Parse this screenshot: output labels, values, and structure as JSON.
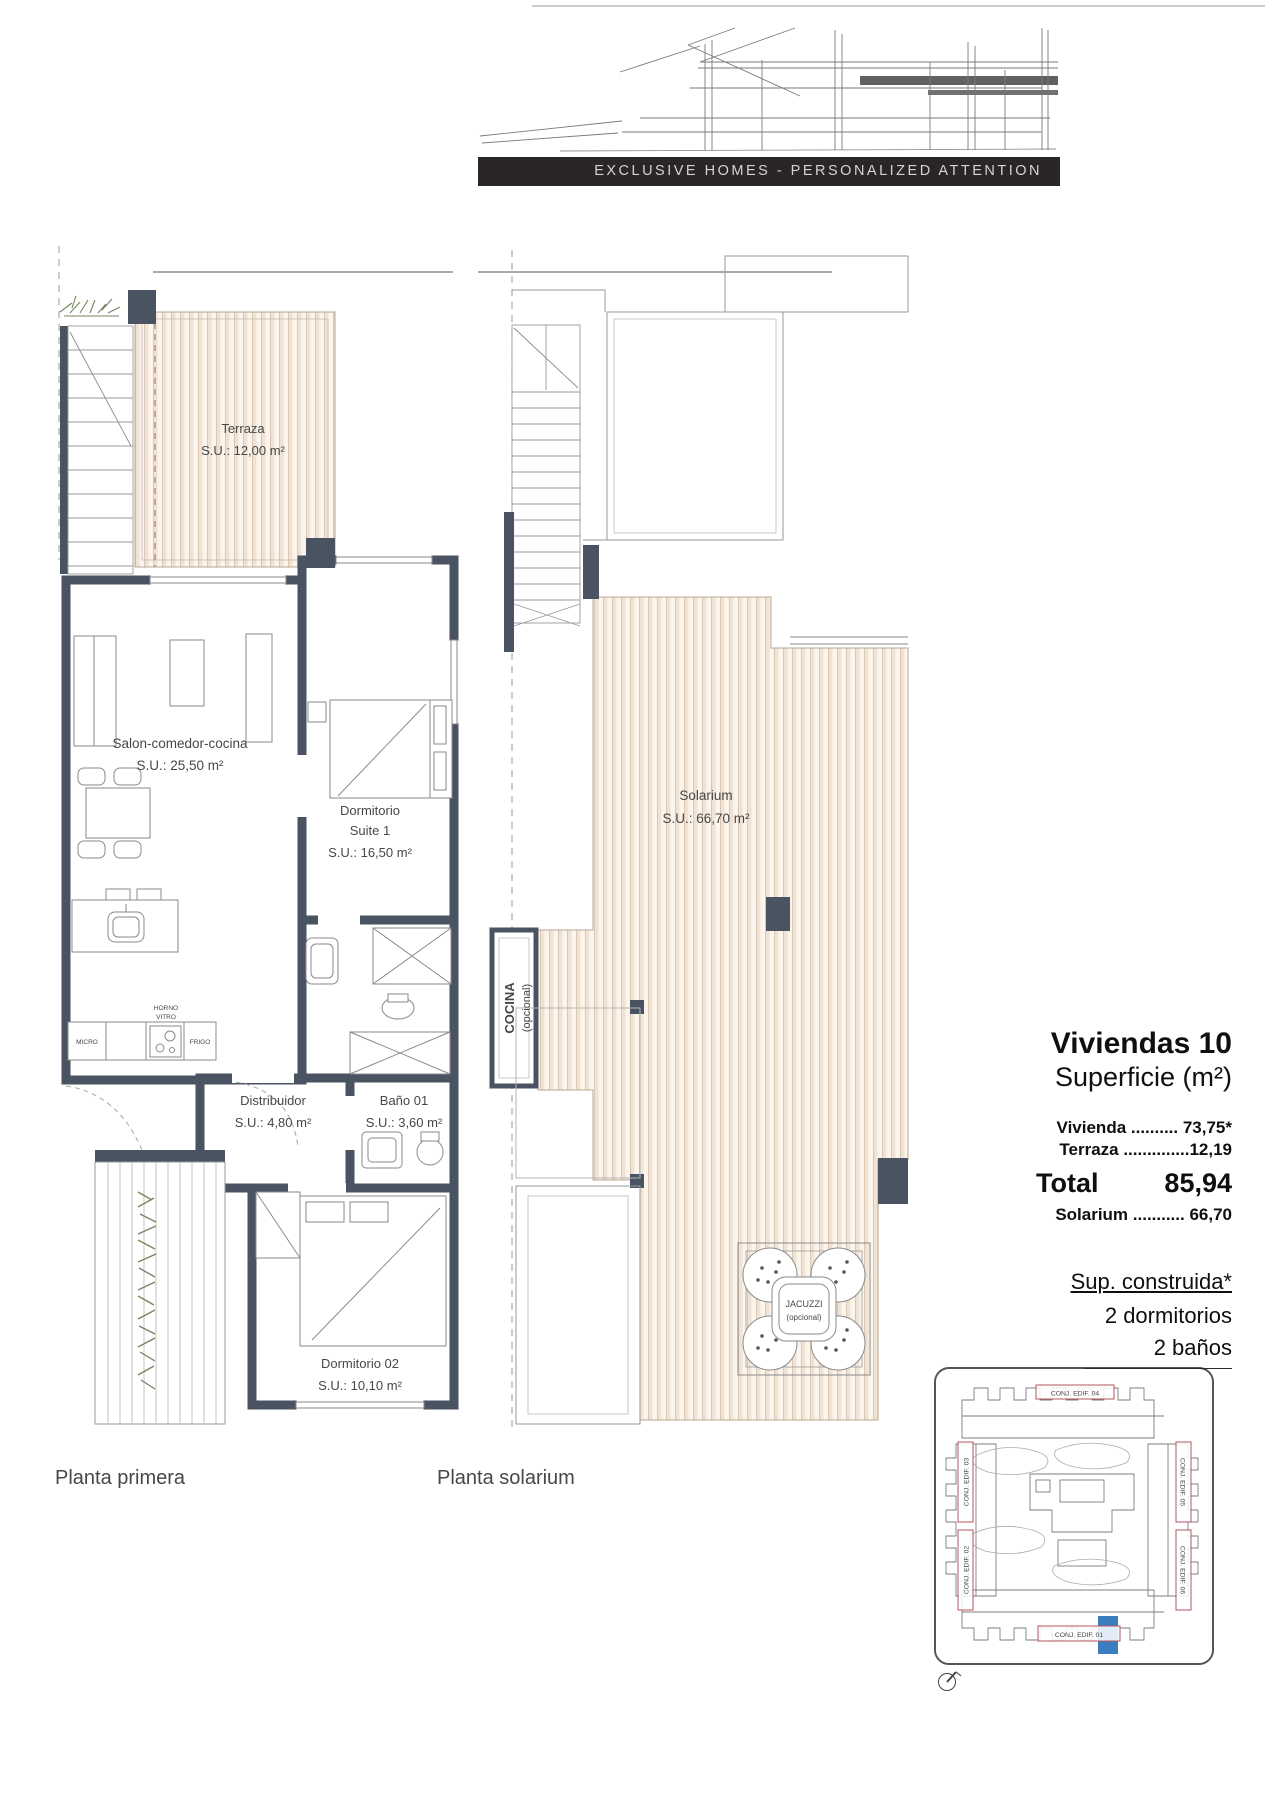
{
  "header": {
    "banner": "EXCLUSIVE HOMES - PERSONALIZED ATTENTION"
  },
  "plan_primera": {
    "caption": "Planta primera",
    "terraza_name": "Terraza",
    "terraza_area": "S.U.: 12,00 m²",
    "salon_name": "Salon-comedor-cocina",
    "salon_area": "S.U.: 25,50 m²",
    "suite_name1": "Dormitorio",
    "suite_name2": "Suite 1",
    "suite_area": "S.U.: 16,50 m²",
    "micro": "MICRO",
    "horno1": "HORNO",
    "horno2": "VITRO",
    "frigo": "FRIGO",
    "distribuidor_name": "Distribuidor",
    "distribuidor_area": "S.U.: 4,80 m²",
    "bano_name": "Baño 01",
    "bano_area": "S.U.: 3,60 m²",
    "dorm02_name": "Dormitorio 02",
    "dorm02_area": "S.U.: 10,10 m²"
  },
  "plan_solarium": {
    "caption": "Planta solarium",
    "solarium_name": "Solarium",
    "solarium_area": "S.U.: 66,70 m²",
    "cocina1": "COCINA",
    "cocina2": "(opcional)",
    "jacuzzi1": "JACUZZI",
    "jacuzzi2": "(opcional)"
  },
  "info_panel": {
    "title": "Viviendas 10",
    "subtitle": "Superficie (m²)",
    "row_vivienda": "Vivienda .......... 73,75*",
    "row_terraza": "Terraza ..............12,19",
    "total_label": "Total",
    "total_value": "85,94",
    "row_solarium": "Solarium ........... 66,70",
    "construida": "Sup. construida*",
    "dormitorios": "2 dormitorios",
    "banos": "2 baños"
  },
  "site_map": {
    "edif01": "CONJ. EDIF. 01",
    "edif02": "CONJ. EDIF. 02",
    "edif03": "CONJ. EDIF. 03",
    "edif04": "CONJ. EDIF. 04",
    "edif05": "CONJ. EDIF. 05",
    "edif06": "CONJ. EDIF. 06"
  },
  "colors": {
    "wall": "#4a5362",
    "deck_base": "#fbf5ee",
    "deck_stripe": "#f1e3d3",
    "deck_line": "#d8c3ae",
    "accent_red": "#b4565e",
    "accent_blue": "#3c7dc0",
    "banner_bg": "#2a2526",
    "plant_green": "#74855f"
  }
}
